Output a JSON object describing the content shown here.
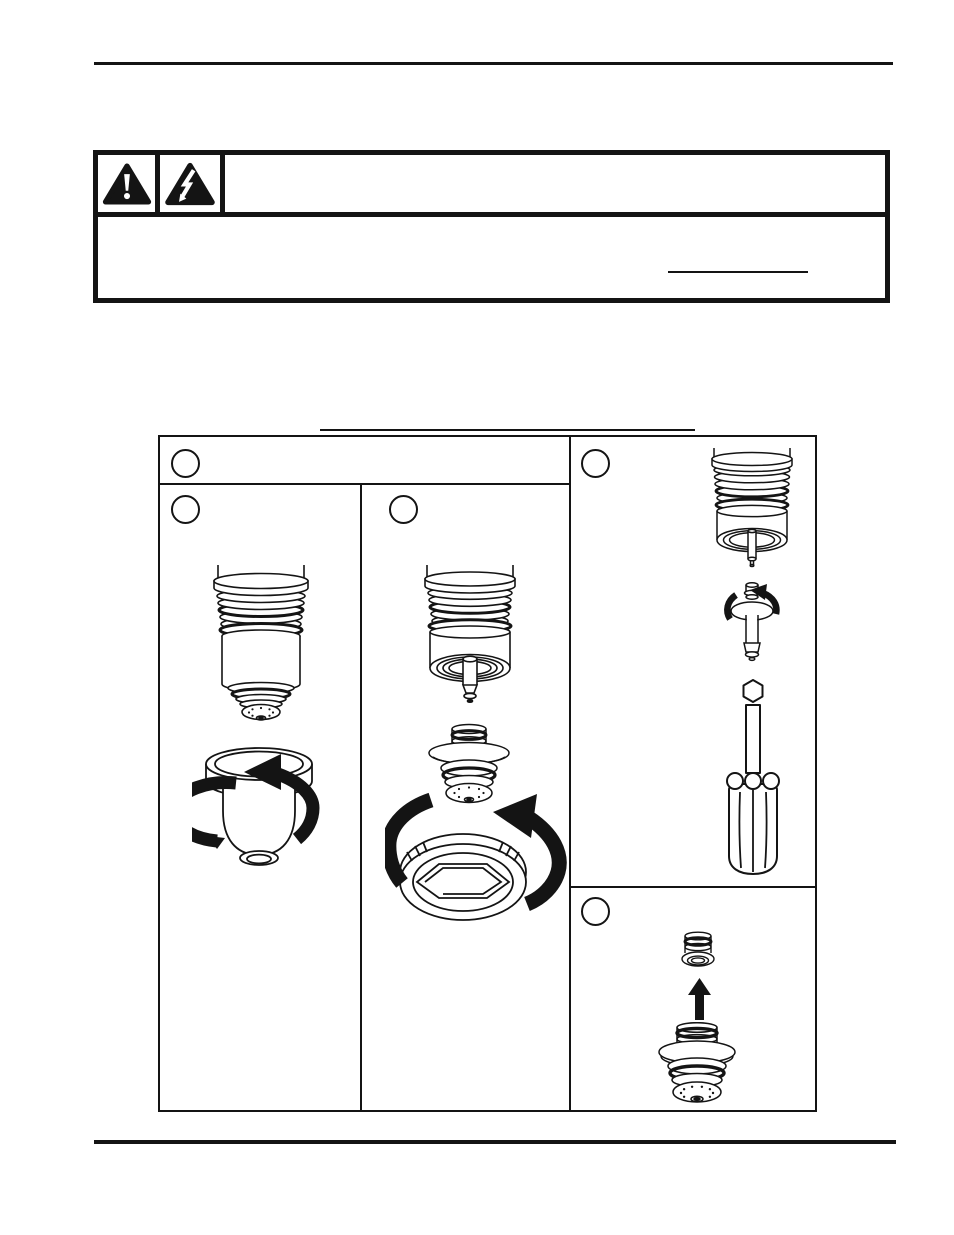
{
  "page": {
    "width": 954,
    "height": 1235,
    "background": "#ffffff",
    "ink": "#141414"
  },
  "top_rule": {
    "type": "horizontal-rule"
  },
  "warning_panel": {
    "type": "warning-notice-box",
    "border_color": "#141414",
    "icons": [
      {
        "name": "exclamation-triangle-icon",
        "meaning": "general warning"
      },
      {
        "name": "lightning-triangle-icon",
        "meaning": "electric shock hazard"
      }
    ],
    "heading_text": "",
    "body_text": "",
    "blank_line_present": true
  },
  "figure": {
    "type": "procedure-diagram",
    "callouts": [
      {
        "id": "figure-header",
        "label": ""
      },
      {
        "id": "panel-left",
        "label": ""
      },
      {
        "id": "panel-middle",
        "label": ""
      },
      {
        "id": "panel-right-top",
        "label": ""
      },
      {
        "id": "panel-right-bottom",
        "label": ""
      }
    ],
    "panels": [
      {
        "id": "panel-left",
        "illustrations": [
          "torch-head-with-shield",
          "retaining-cap-with-rotation-arrows"
        ]
      },
      {
        "id": "panel-middle",
        "illustrations": [
          "torch-head-open-end",
          "nozzle-shield-assembly",
          "retaining-cap-underside-with-rotation-arrow"
        ]
      },
      {
        "id": "panel-right-top",
        "illustrations": [
          "torch-head-short",
          "electrode-with-rotation-arrow",
          "screwdriver"
        ]
      },
      {
        "id": "panel-right-bottom",
        "illustrations": [
          "nozzle",
          "up-arrow",
          "shield-assembly"
        ]
      }
    ]
  },
  "bottom_rule": {
    "type": "horizontal-rule"
  }
}
